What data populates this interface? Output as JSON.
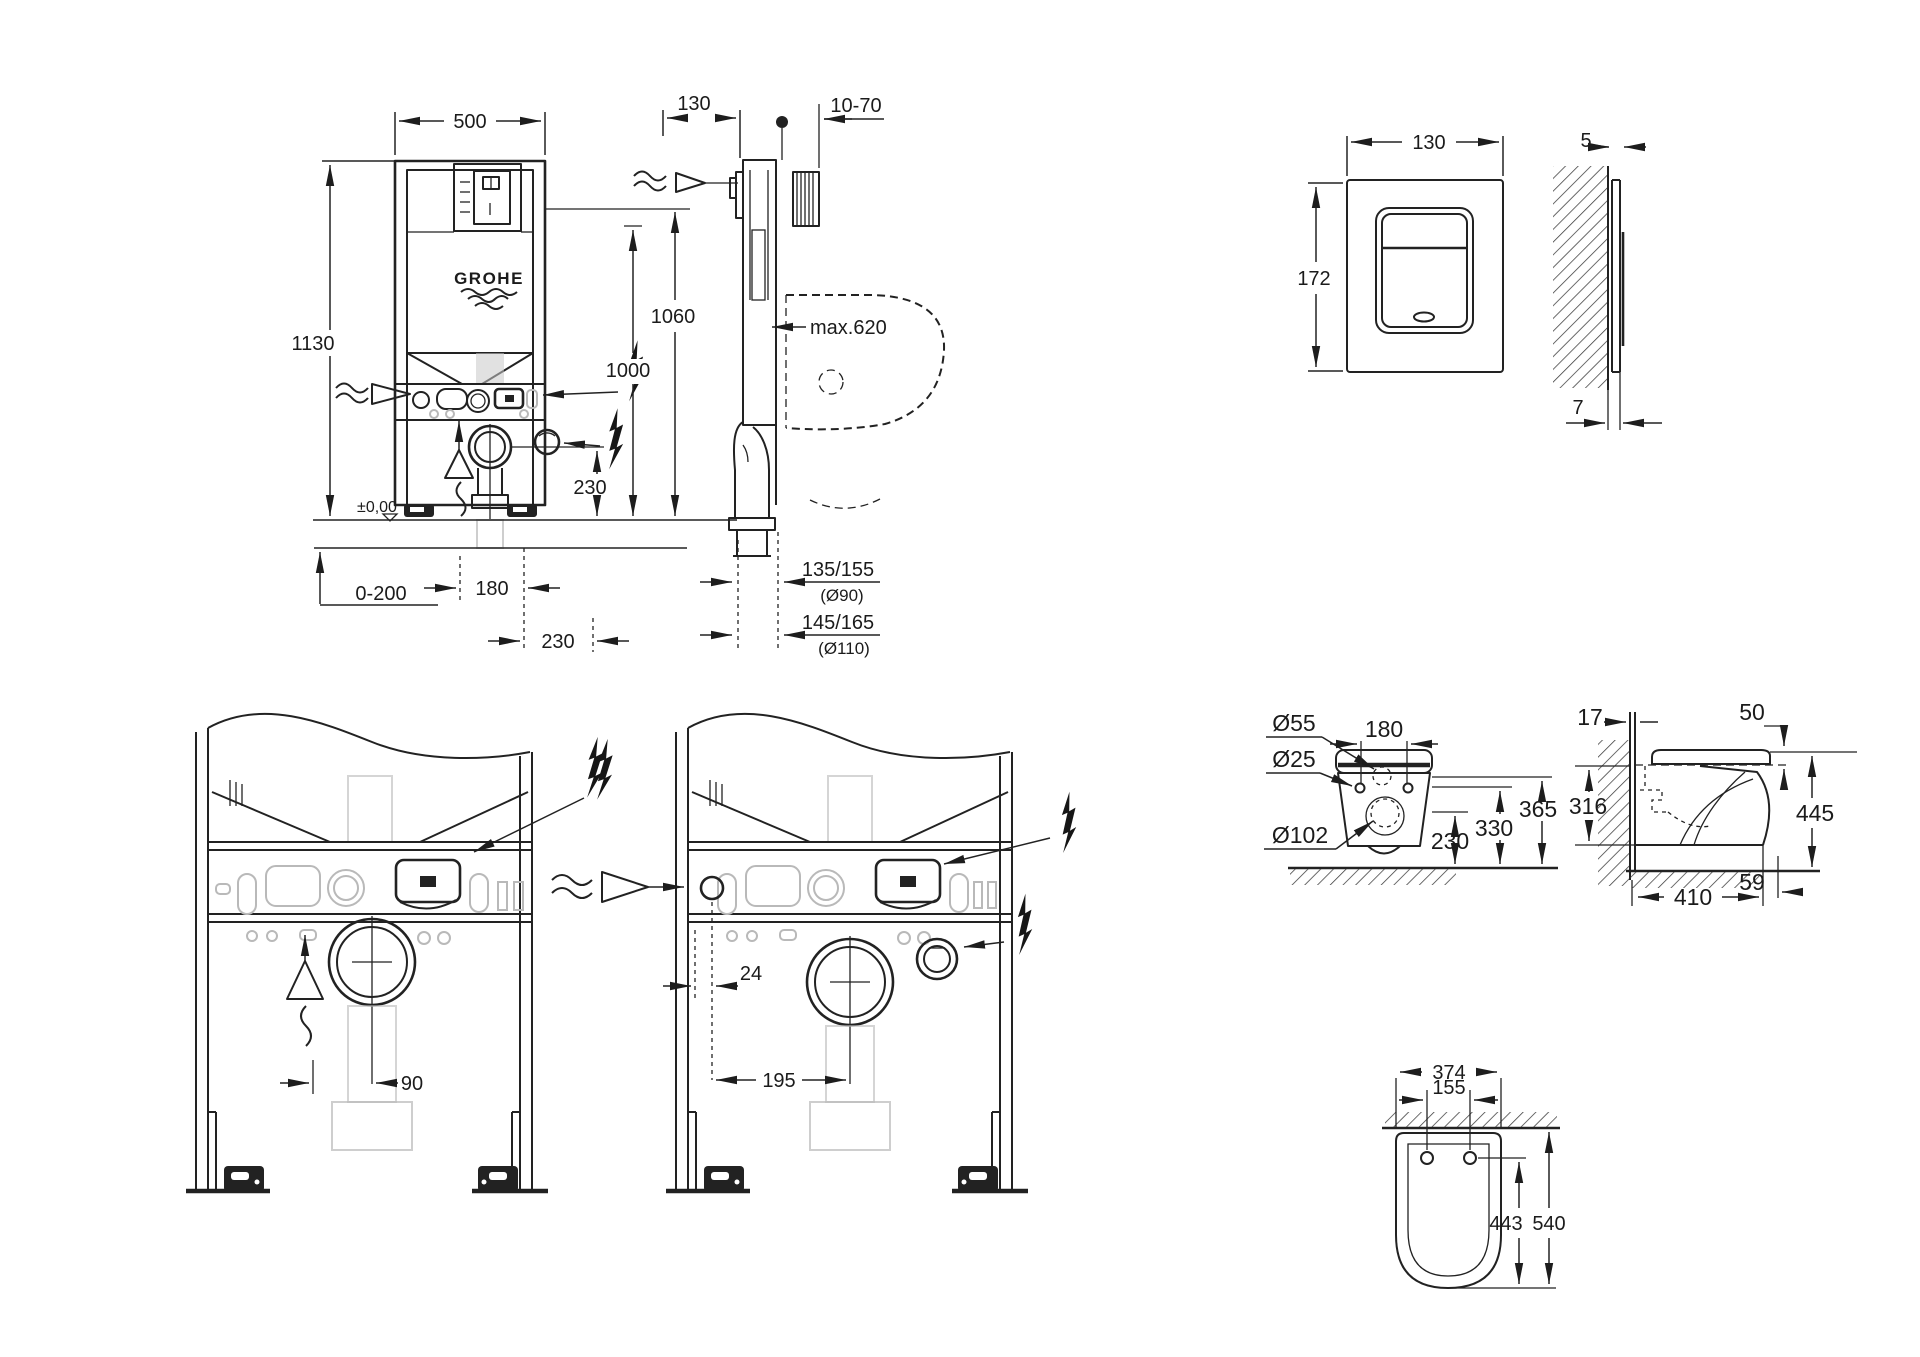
{
  "drawing": {
    "brand": "GROHE",
    "frame_front": {
      "width": "500",
      "height": "1130",
      "supply_height": "1000",
      "drain_height": "230",
      "level": "±0,00",
      "floor_range": "0-200",
      "pipe_offset": "180",
      "drain_offset": "230"
    },
    "frame_side": {
      "depth": "130",
      "wall_gap": "10-70",
      "flush_height": "1060",
      "max_reach": "max.620",
      "outlet_a": "135/155",
      "outlet_a_pipe": "(Ø90)",
      "outlet_b": "145/165",
      "outlet_b_pipe": "(Ø110)"
    },
    "plate_front": {
      "width": "130",
      "height": "172"
    },
    "plate_side": {
      "thickness": "5",
      "protrusion": "7"
    },
    "base_left": {
      "drain_offset": "90"
    },
    "base_mid": {
      "supply_offset": "24",
      "drain_offset": "195"
    },
    "wc_rear": {
      "hole_top": "Ø55",
      "bolt_spacing": "180",
      "hole_small": "Ø25",
      "hole_drain": "Ø102",
      "h_drain": "230",
      "h_bolts": "330",
      "h_top": "365"
    },
    "wc_side": {
      "wall_offset": "17",
      "seat_thickness": "50",
      "body_height": "316",
      "total_height": "445",
      "depth": "410",
      "front_lip": "59"
    },
    "wc_top": {
      "width": "374",
      "bolt_spacing": "155",
      "depth": "443",
      "total_depth": "540"
    }
  }
}
